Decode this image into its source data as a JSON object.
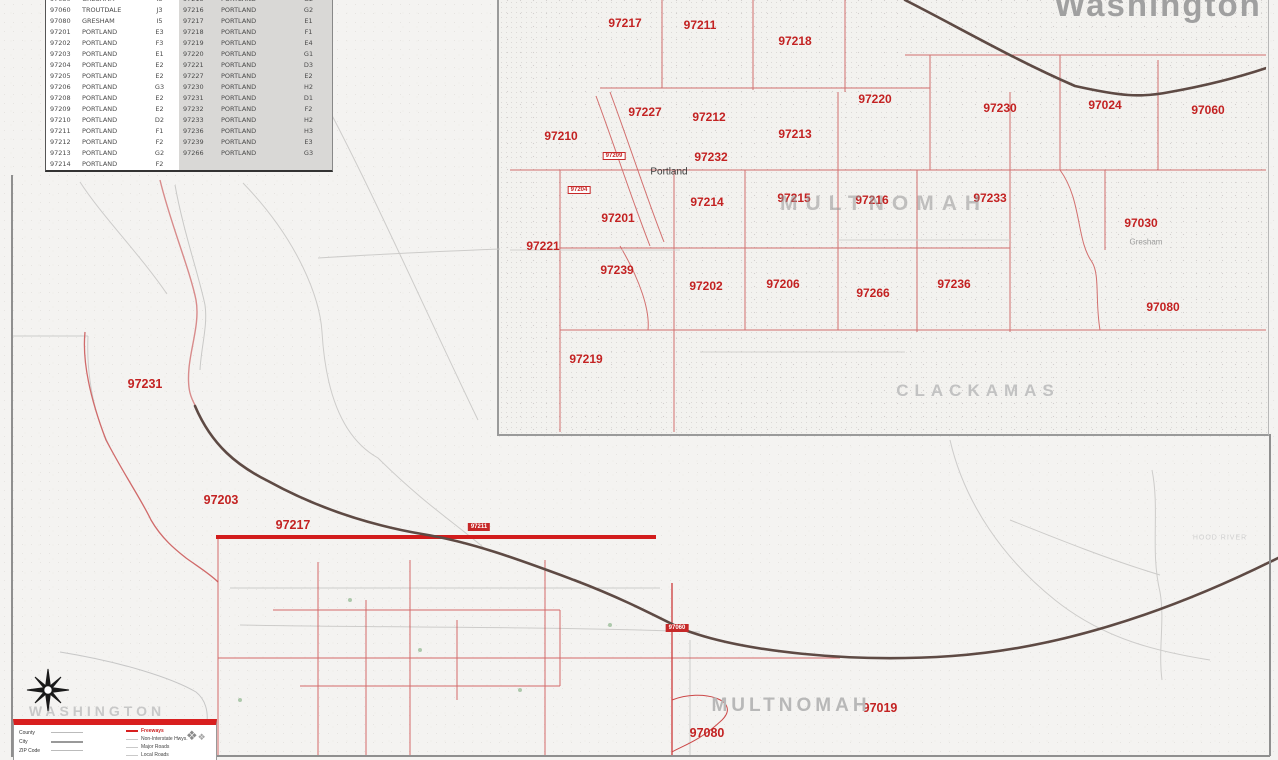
{
  "colors": {
    "zip_red": "#c32222",
    "highlight_red": "#d21c1c",
    "county_gray": "#bdbdbd",
    "river_brown": "#5e4a44",
    "table_shade": "#d9d8d6"
  },
  "table": {
    "rows": [
      [
        "97030",
        "GRESHAM",
        "I3",
        "97215",
        "PORTLAND",
        "G2"
      ],
      [
        "97060",
        "TROUTDALE",
        "J3",
        "97216",
        "PORTLAND",
        "G2"
      ],
      [
        "97080",
        "GRESHAM",
        "I5",
        "97217",
        "PORTLAND",
        "E1"
      ],
      [
        "97201",
        "PORTLAND",
        "E3",
        "97218",
        "PORTLAND",
        "F1"
      ],
      [
        "97202",
        "PORTLAND",
        "F3",
        "97219",
        "PORTLAND",
        "E4"
      ],
      [
        "97203",
        "PORTLAND",
        "E1",
        "97220",
        "PORTLAND",
        "G1"
      ],
      [
        "97204",
        "PORTLAND",
        "E2",
        "97221",
        "PORTLAND",
        "D3"
      ],
      [
        "97205",
        "PORTLAND",
        "E2",
        "97227",
        "PORTLAND",
        "E2"
      ],
      [
        "97206",
        "PORTLAND",
        "G3",
        "97230",
        "PORTLAND",
        "H2"
      ],
      [
        "97208",
        "PORTLAND",
        "E2",
        "97231",
        "PORTLAND",
        "D1"
      ],
      [
        "97209",
        "PORTLAND",
        "E2",
        "97232",
        "PORTLAND",
        "F2"
      ],
      [
        "97210",
        "PORTLAND",
        "D2",
        "97233",
        "PORTLAND",
        "H2"
      ],
      [
        "97211",
        "PORTLAND",
        "F1",
        "97236",
        "PORTLAND",
        "H3"
      ],
      [
        "97212",
        "PORTLAND",
        "F2",
        "97239",
        "PORTLAND",
        "E3"
      ],
      [
        "97213",
        "PORTLAND",
        "G2",
        "97266",
        "PORTLAND",
        "G3"
      ],
      [
        "97214",
        "PORTLAND",
        "F2",
        "",
        "",
        ""
      ]
    ]
  },
  "map_labels": [
    {
      "text": "97217",
      "x": 625,
      "y": 23,
      "cls": "zip"
    },
    {
      "text": "97211",
      "x": 700,
      "y": 25,
      "cls": "zip"
    },
    {
      "text": "97218",
      "x": 795,
      "y": 41,
      "cls": "zip"
    },
    {
      "text": "97220",
      "x": 875,
      "y": 99,
      "cls": "zip"
    },
    {
      "text": "97230",
      "x": 1000,
      "y": 108,
      "cls": "zip"
    },
    {
      "text": "97024",
      "x": 1105,
      "y": 105,
      "cls": "zip"
    },
    {
      "text": "97060",
      "x": 1208,
      "y": 110,
      "cls": "zip"
    },
    {
      "text": "97210",
      "x": 561,
      "y": 136,
      "cls": "zip"
    },
    {
      "text": "97227",
      "x": 645,
      "y": 112,
      "cls": "zip"
    },
    {
      "text": "97212",
      "x": 709,
      "y": 117,
      "cls": "zip"
    },
    {
      "text": "97213",
      "x": 795,
      "y": 134,
      "cls": "zip"
    },
    {
      "text": "97232",
      "x": 711,
      "y": 157,
      "cls": "zip"
    },
    {
      "text": "97201",
      "x": 618,
      "y": 218,
      "cls": "zip"
    },
    {
      "text": "97214",
      "x": 707,
      "y": 202,
      "cls": "zip"
    },
    {
      "text": "97215",
      "x": 794,
      "y": 198,
      "cls": "zip"
    },
    {
      "text": "97216",
      "x": 872,
      "y": 200,
      "cls": "zip"
    },
    {
      "text": "97233",
      "x": 990,
      "y": 198,
      "cls": "zip"
    },
    {
      "text": "97030",
      "x": 1141,
      "y": 223,
      "cls": "zip"
    },
    {
      "text": "97221",
      "x": 543,
      "y": 246,
      "cls": "zip"
    },
    {
      "text": "97239",
      "x": 617,
      "y": 270,
      "cls": "zip"
    },
    {
      "text": "97202",
      "x": 706,
      "y": 286,
      "cls": "zip"
    },
    {
      "text": "97206",
      "x": 783,
      "y": 284,
      "cls": "zip"
    },
    {
      "text": "97266",
      "x": 873,
      "y": 293,
      "cls": "zip"
    },
    {
      "text": "97236",
      "x": 954,
      "y": 284,
      "cls": "zip"
    },
    {
      "text": "97080",
      "x": 1163,
      "y": 307,
      "cls": "zip"
    },
    {
      "text": "97219",
      "x": 586,
      "y": 359,
      "cls": "zip"
    },
    {
      "text": "97231",
      "x": 145,
      "y": 384,
      "cls": "zip-main"
    },
    {
      "text": "97203",
      "x": 221,
      "y": 500,
      "cls": "zip-main"
    },
    {
      "text": "97217",
      "x": 293,
      "y": 525,
      "cls": "zip-main"
    },
    {
      "text": "97019",
      "x": 880,
      "y": 708,
      "cls": "zip-main"
    },
    {
      "text": "97080",
      "x": 707,
      "y": 733,
      "cls": "zip-main"
    },
    {
      "text": "97209",
      "x": 614,
      "y": 156,
      "cls": "box-line"
    },
    {
      "text": "97204",
      "x": 579,
      "y": 190,
      "cls": "box-line"
    },
    {
      "text": "97211",
      "x": 479,
      "y": 527,
      "cls": "box-fill"
    },
    {
      "text": "97060",
      "x": 677,
      "y": 628,
      "cls": "box-fill"
    },
    {
      "text": "Washington",
      "x": 1158,
      "y": 5,
      "cls": "state"
    },
    {
      "text": "MULTNOMAH",
      "x": 884,
      "y": 204,
      "cls": "county-xl"
    },
    {
      "text": "CLACKAMAS",
      "x": 978,
      "y": 391,
      "cls": "county-lg"
    },
    {
      "text": "MULTNOMAH",
      "x": 791,
      "y": 706,
      "cls": "county-md"
    },
    {
      "text": "WASHINGTON",
      "x": 97,
      "y": 711,
      "cls": "county-sm"
    },
    {
      "text": "HOOD RIVER",
      "x": 1220,
      "y": 538,
      "cls": "faint"
    },
    {
      "text": "Portland",
      "x": 669,
      "y": 172,
      "cls": "city"
    },
    {
      "text": "Gresham",
      "x": 1146,
      "y": 242,
      "cls": "city-sm"
    }
  ],
  "legend": {
    "area_items": [
      {
        "label": "County"
      },
      {
        "label": "City"
      },
      {
        "label": "ZIP Code"
      }
    ],
    "road_items": [
      {
        "label": "Freeways"
      },
      {
        "label": "Non-Interstate Hwys."
      },
      {
        "label": "Major Roads"
      },
      {
        "label": "Local Roads"
      }
    ],
    "logo_glyph": "❖",
    "logo_glyph_small": "❖"
  }
}
